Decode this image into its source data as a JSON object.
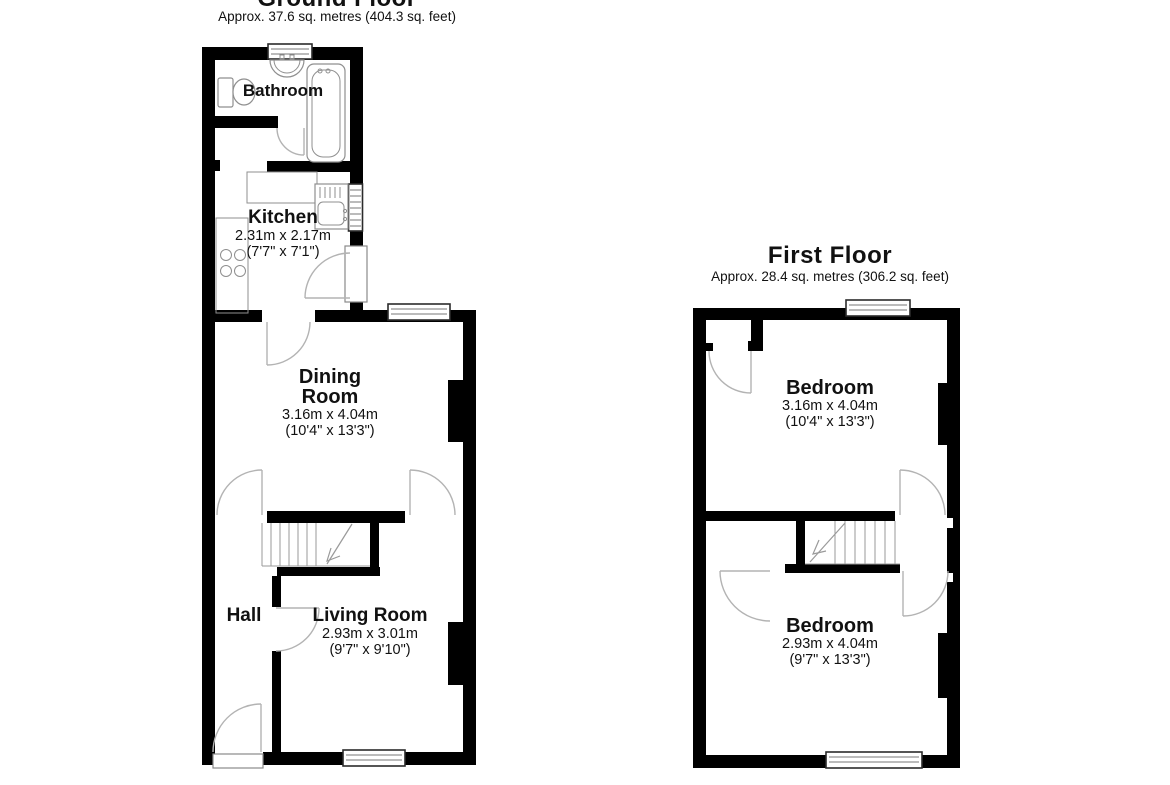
{
  "ground_floor": {
    "title": "Ground Floor",
    "subtitle": "Approx. 37.6 sq. metres (404.3 sq. feet)",
    "rooms": {
      "bathroom": {
        "name": "Bathroom"
      },
      "kitchen": {
        "name": "Kitchen",
        "dims_m": "2.31m x 2.17m",
        "dims_ft": "(7'7\" x 7'1\")"
      },
      "dining": {
        "name": "Dining Room",
        "dims_m": "3.16m x 4.04m",
        "dims_ft": "(10'4\" x 13'3\")"
      },
      "hall": {
        "name": "Hall"
      },
      "living": {
        "name": "Living Room",
        "dims_m": "2.93m x 3.01m",
        "dims_ft": "(9'7\" x 9'10\")"
      }
    }
  },
  "first_floor": {
    "title": "First Floor",
    "subtitle": "Approx. 28.4 sq. metres (306.2 sq. feet)",
    "rooms": {
      "bedroom1": {
        "name": "Bedroom",
        "dims_m": "3.16m x 4.04m",
        "dims_ft": "(10'4\" x 13'3\")"
      },
      "bedroom2": {
        "name": "Bedroom",
        "dims_m": "2.93m x 4.04m",
        "dims_ft": "(9'7\" x 13'3\")"
      }
    }
  },
  "colors": {
    "wall": "#000000",
    "door_line": "#b3b3b3",
    "background": "#ffffff",
    "text": "#111111"
  }
}
